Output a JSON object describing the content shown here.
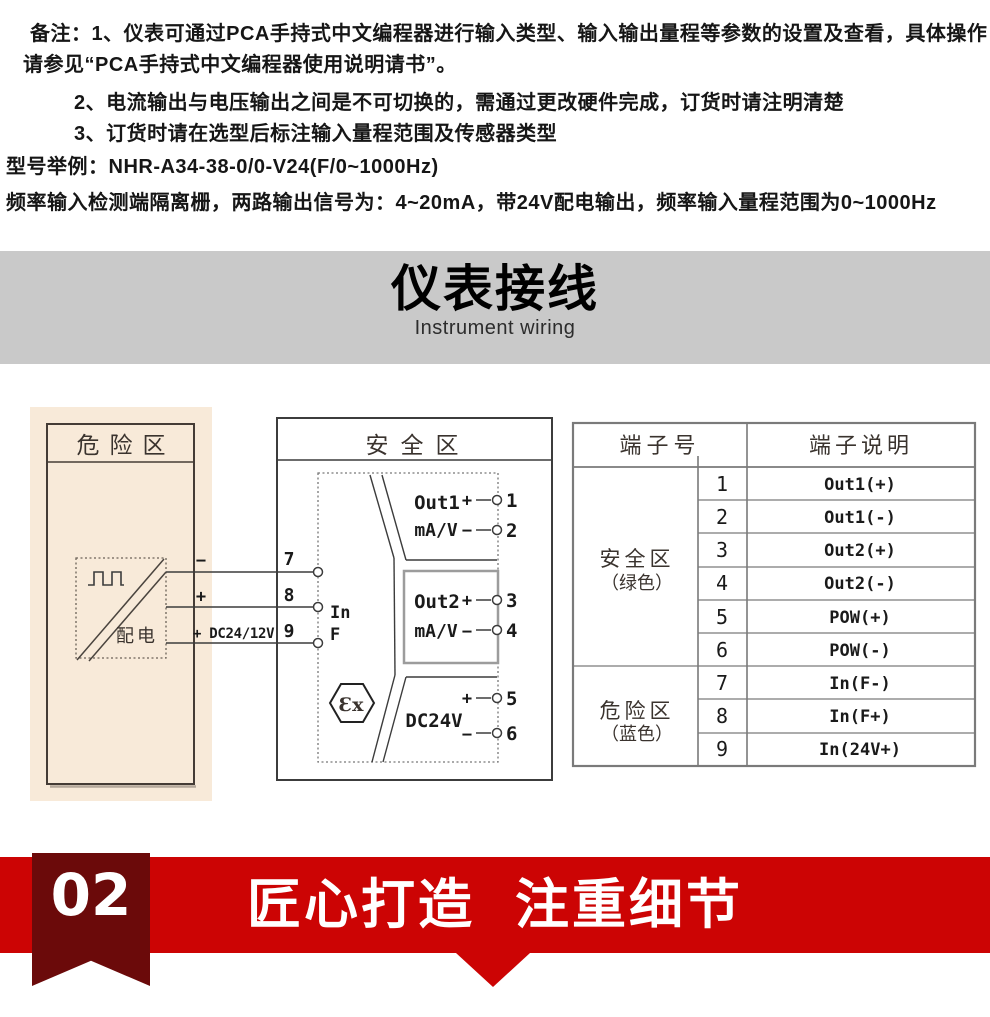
{
  "notes": {
    "line1": "备注：1、仪表可通过PCA手持式中文编程器进行输入类型、输入输出量程等参数的设置及查看，具体操作",
    "line2": "请参见“PCA手持式中文编程器使用说明请书”。",
    "line3": "2、电流输出与电压输出之间是不可切换的，需通过更改硬件完成，订货时请注明清楚",
    "line4": "3、订货时请在选型后标注输入量程范围及传感器类型",
    "line5": "型号举例：NHR-A34-38-0/0-V24(F/0~1000Hz)",
    "line6": "频率输入检测端隔离栅，两路输出信号为：4~20mA，带24V配电输出，频率输入量程范围为0~1000Hz"
  },
  "section_banner": {
    "title": "仪表接线",
    "subtitle": "Instrument wiring"
  },
  "diagram": {
    "hazard_zone": {
      "title": "危险区",
      "device_label": "配电",
      "wire_minus": "−",
      "wire_plus": "+",
      "wire_supply": "+ DC24/12V",
      "terminal_7": "7",
      "terminal_8": "8",
      "terminal_9": "9"
    },
    "safe_zone": {
      "title": "安全区",
      "input_line1": "In",
      "input_line2": "F",
      "ex_mark": "Ɛx",
      "out1": {
        "name": "Out1",
        "unit": "mA/V",
        "plus": "+",
        "minus": "−",
        "t_plus": "1",
        "t_minus": "2"
      },
      "out2": {
        "name": "Out2",
        "unit": "mA/V",
        "plus": "+",
        "minus": "−",
        "t_plus": "3",
        "t_minus": "4"
      },
      "power": {
        "name": "DC24V",
        "plus": "+",
        "minus": "−",
        "t_plus": "5",
        "t_minus": "6"
      }
    }
  },
  "table": {
    "header_no": "端子号",
    "header_desc": "端子说明",
    "groups": [
      {
        "name": "安全区",
        "color": "（绿色）"
      },
      {
        "name": "危险区",
        "color": "（蓝色）"
      }
    ],
    "rows": [
      {
        "num": "1",
        "desc": "Out1(+)"
      },
      {
        "num": "2",
        "desc": "Out1(-)"
      },
      {
        "num": "3",
        "desc": "Out2(+)"
      },
      {
        "num": "4",
        "desc": "Out2(-)"
      },
      {
        "num": "5",
        "desc": "POW(+)"
      },
      {
        "num": "6",
        "desc": "POW(-)"
      },
      {
        "num": "7",
        "desc": "In(F-)"
      },
      {
        "num": "8",
        "desc": "In(F+)"
      },
      {
        "num": "9",
        "desc": "In(24V+)"
      }
    ]
  },
  "footer": {
    "index": "02",
    "slogan": "匠心打造 注重细节"
  },
  "colors": {
    "band_red": "#cc0404",
    "ribbon_dark_red": "#6b0a0a",
    "hazard_panel_beige": "#f8ead9",
    "banner_gray": "#c9c9c9"
  }
}
